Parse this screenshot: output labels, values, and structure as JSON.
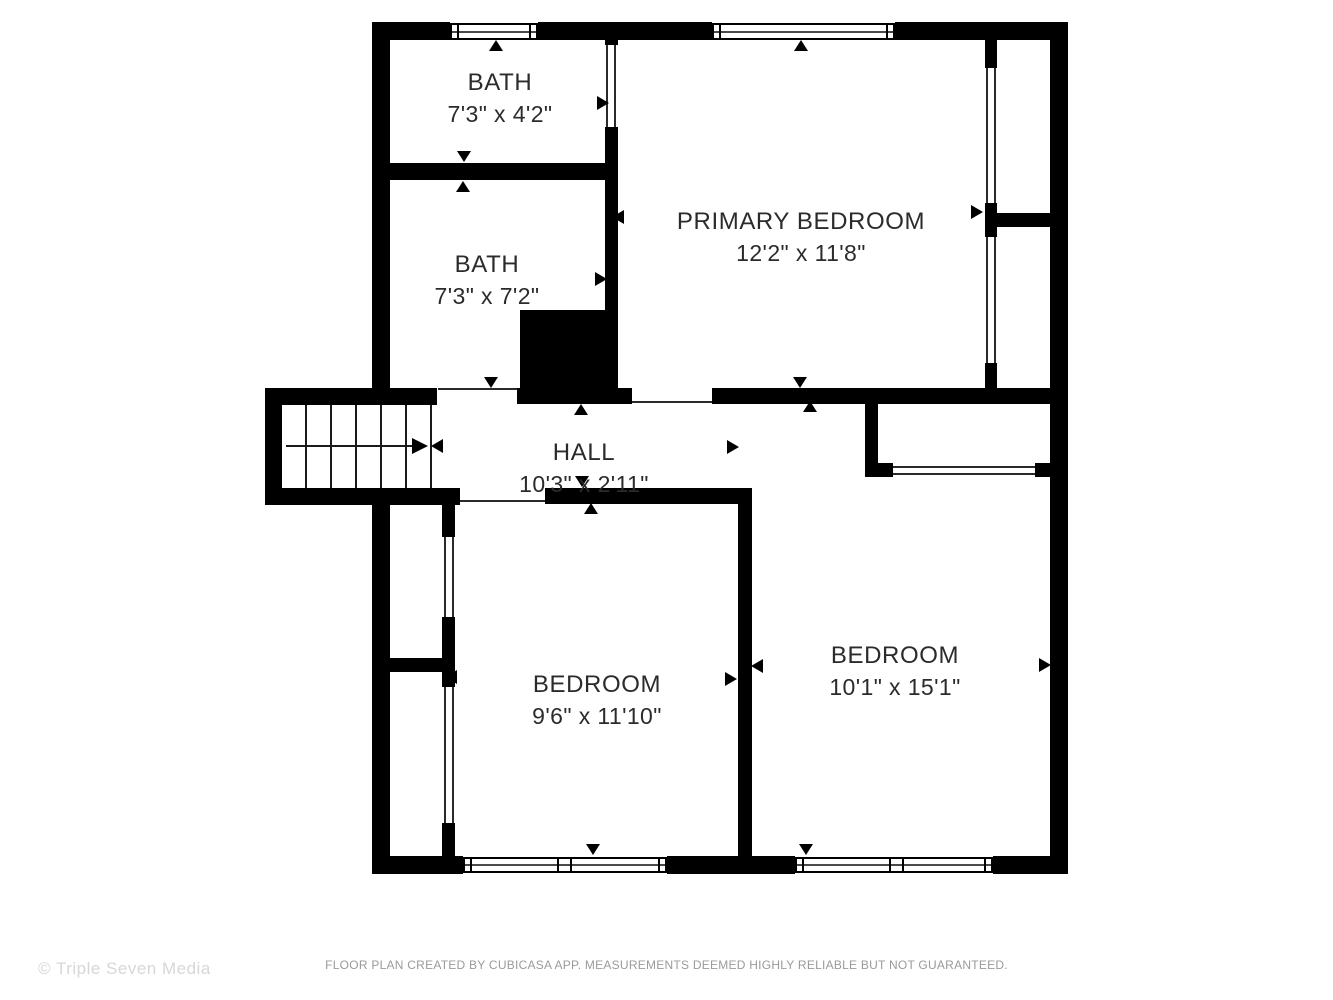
{
  "title": "Floor plan",
  "rooms": {
    "bath1": {
      "name": "BATH",
      "dims": "7'3\" x 4'2\""
    },
    "bath2": {
      "name": "BATH",
      "dims": "7'3\" x 7'2\""
    },
    "primary": {
      "name": "PRIMARY BEDROOM",
      "dims": "12'2\" x 11'8\""
    },
    "hall": {
      "name": "HALL",
      "dims": "10'3\" x 2'11\""
    },
    "bedroom_left": {
      "name": "BEDROOM",
      "dims": "9'6\" x 11'10\""
    },
    "bedroom_right": {
      "name": "BEDROOM",
      "dims": "10'1\" x 15'1\""
    }
  },
  "footer": {
    "disclaimer": "FLOOR PLAN CREATED BY CUBICASA APP. MEASUREMENTS DEEMED HIGHLY RELIABLE BUT NOT GUARANTEED."
  },
  "watermark": {
    "text": "© Triple Seven Media"
  },
  "colors": {
    "background": "#ffffff",
    "wall": "#000000",
    "label_text": "#2b2b2b",
    "disclaimer_text": "#9a9a9a",
    "watermark_text": "#d7d7d7"
  }
}
